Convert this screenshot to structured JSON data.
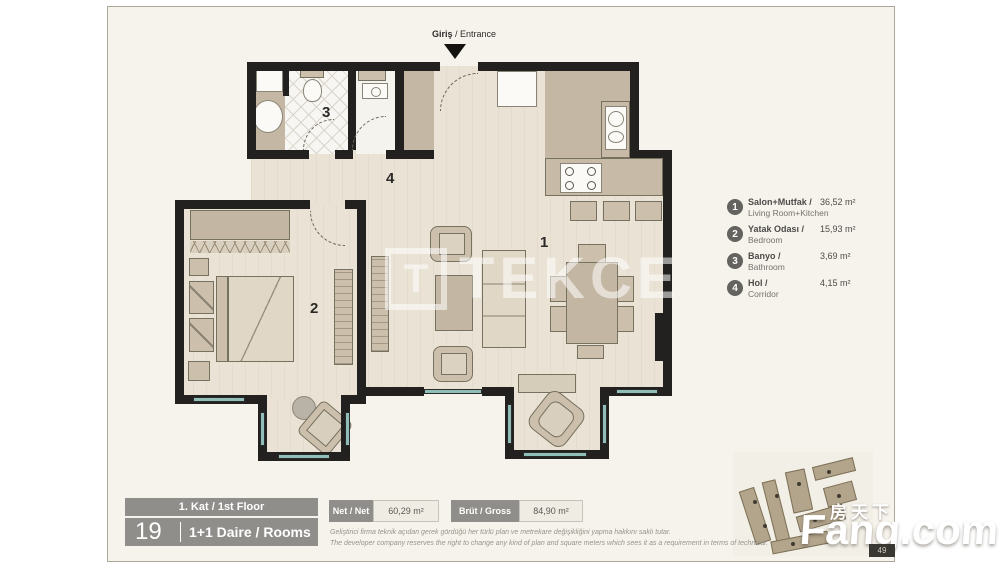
{
  "entrance": {
    "tr": "Giriş",
    "sep": " / ",
    "en": "Entrance"
  },
  "rooms": {
    "living": "1",
    "bedroom": "2",
    "bath": "3",
    "hall": "4"
  },
  "legend": {
    "items": [
      {
        "num": "1",
        "title": "Salon+Mutfak /",
        "subtitle": "Living Room+Kitchen",
        "area": "36,52 m²"
      },
      {
        "num": "2",
        "title": "Yatak Odası /",
        "subtitle": "Bedroom",
        "area": "15,93 m²"
      },
      {
        "num": "3",
        "title": "Banyo /",
        "subtitle": "Bathroom",
        "area": "3,69 m²"
      },
      {
        "num": "4",
        "title": "Hol /",
        "subtitle": "Corridor",
        "area": "4,15 m²"
      }
    ]
  },
  "floor_info": {
    "floor_label": "1. Kat / 1st Floor",
    "unit_no": "19",
    "type_label": "1+1 Daire / Rooms"
  },
  "metrics": {
    "net_label": "Net / Net",
    "net_value": "60,29 m²",
    "gross_label": "Brüt / Gross",
    "gross_value": "84,90 m²"
  },
  "disclaimer": {
    "line_tr": "Geliştirici firma teknik açıdan gerek gördüğü her türlü plan ve metrekare değişikliğini yapma hakkını saklı tutar.",
    "line_en": "The developer company reserves the right to change any kind of plan and square meters which sees it as a requirement in terms of technical."
  },
  "watermarks": {
    "logo_letter": "T",
    "logo_text": "TEKCE",
    "site_cn": "房天下",
    "site_name": "Fang.com",
    "badge": "49"
  },
  "colors": {
    "wall": "#22211f",
    "floor_wood": "#eae3d5",
    "floor_tan": "#c4b7a4",
    "window_teal": "#8fbfb8",
    "info_gray": "#8f8e8b",
    "card_bg": "#f6f3ec"
  }
}
